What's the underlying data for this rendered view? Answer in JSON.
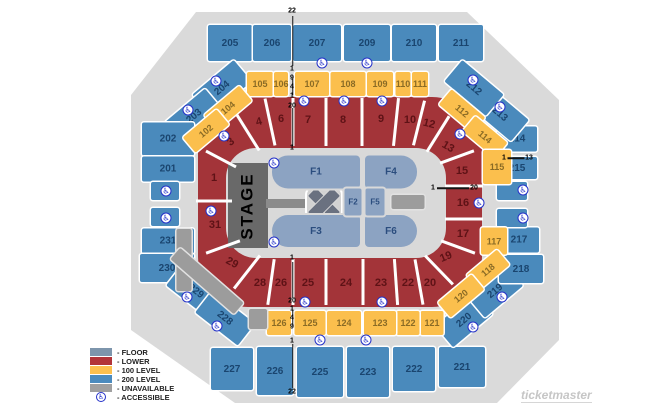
{
  "brand": "ticketmaster",
  "colors": {
    "floor": "#8CA3C2",
    "lower": "#A33439",
    "level100": "#FBBF4D",
    "level200": "#4A8ABC",
    "unavailable": "#9C9C9C",
    "stage": "#696969",
    "accessible": "#2431C9"
  },
  "legend": {
    "items": [
      {
        "label": "- FLOOR",
        "swatch": "#7D95AC"
      },
      {
        "label": "- LOWER",
        "swatch": "#B23439"
      },
      {
        "label": "- 100 LEVEL",
        "swatch": "#FCC04F"
      },
      {
        "label": "- 200 LEVEL",
        "swatch": "#4B8BBE"
      },
      {
        "label": "- UNAVAILABLE",
        "swatch": "#A0A0A0"
      },
      {
        "label": "- ACCESSIBLE",
        "swatch": "icon"
      }
    ]
  },
  "map": {
    "stage_label": "STAGE",
    "sections": [
      {
        "label": "205",
        "lv": "200",
        "cx": 230,
        "cy": 43,
        "w": 44,
        "h": 36
      },
      {
        "label": "206",
        "lv": "200",
        "cx": 272,
        "cy": 43,
        "w": 38,
        "h": 36
      },
      {
        "label": "207",
        "lv": "200",
        "cx": 317,
        "cy": 43,
        "w": 48,
        "h": 36
      },
      {
        "label": "209",
        "lv": "200",
        "cx": 367,
        "cy": 43,
        "w": 46,
        "h": 36
      },
      {
        "label": "210",
        "lv": "200",
        "cx": 414,
        "cy": 43,
        "w": 44,
        "h": 36
      },
      {
        "label": "211",
        "lv": "200",
        "cx": 461,
        "cy": 43,
        "w": 44,
        "h": 36
      },
      {
        "label": "204",
        "lv": "200",
        "cx": 222,
        "cy": 88,
        "w": 54,
        "h": 28,
        "r": -40
      },
      {
        "label": "203",
        "lv": "200",
        "cx": 194,
        "cy": 116,
        "w": 52,
        "h": 28,
        "r": -40
      },
      {
        "label": "202",
        "lv": "200",
        "cx": 168,
        "cy": 139,
        "w": 52,
        "h": 33
      },
      {
        "label": "201",
        "lv": "200",
        "cx": 168,
        "cy": 169,
        "w": 52,
        "h": 25
      },
      {
        "label": "",
        "lv": "200",
        "cx": 165,
        "cy": 191,
        "w": 28,
        "h": 18
      },
      {
        "label": "",
        "lv": "200",
        "cx": 165,
        "cy": 217,
        "w": 28,
        "h": 18
      },
      {
        "label": "231",
        "lv": "200",
        "cx": 168,
        "cy": 241,
        "w": 52,
        "h": 25
      },
      {
        "label": "230",
        "lv": "200",
        "cx": 167,
        "cy": 268,
        "w": 54,
        "h": 28
      },
      {
        "label": "229",
        "lv": "200",
        "cx": 196,
        "cy": 291,
        "w": 54,
        "h": 28,
        "r": 38
      },
      {
        "label": "228",
        "lv": "200",
        "cx": 225,
        "cy": 318,
        "w": 54,
        "h": 28,
        "r": 38
      },
      {
        "label": "227",
        "lv": "200",
        "cx": 232,
        "cy": 369,
        "w": 42,
        "h": 42
      },
      {
        "label": "226",
        "lv": "200",
        "cx": 275,
        "cy": 371,
        "w": 36,
        "h": 48
      },
      {
        "label": "225",
        "lv": "200",
        "cx": 320,
        "cy": 372,
        "w": 46,
        "h": 50
      },
      {
        "label": "223",
        "lv": "200",
        "cx": 368,
        "cy": 372,
        "w": 42,
        "h": 50
      },
      {
        "label": "222",
        "lv": "200",
        "cx": 414,
        "cy": 369,
        "w": 42,
        "h": 44
      },
      {
        "label": "221",
        "lv": "200",
        "cx": 462,
        "cy": 367,
        "w": 46,
        "h": 40
      },
      {
        "label": "220",
        "lv": "200",
        "cx": 464,
        "cy": 320,
        "w": 52,
        "h": 28,
        "r": -40
      },
      {
        "label": "219",
        "lv": "200",
        "cx": 495,
        "cy": 291,
        "w": 50,
        "h": 28,
        "r": -40
      },
      {
        "label": "218",
        "lv": "200",
        "cx": 521,
        "cy": 269,
        "w": 44,
        "h": 28
      },
      {
        "label": "217",
        "lv": "200",
        "cx": 519,
        "cy": 240,
        "w": 40,
        "h": 25
      },
      {
        "label": "",
        "lv": "200",
        "cx": 512,
        "cy": 218,
        "w": 30,
        "h": 18
      },
      {
        "label": "",
        "lv": "200",
        "cx": 512,
        "cy": 191,
        "w": 30,
        "h": 18
      },
      {
        "label": "215",
        "lv": "200",
        "cx": 517,
        "cy": 168,
        "w": 40,
        "h": 22
      },
      {
        "label": "214",
        "lv": "200",
        "cx": 517,
        "cy": 139,
        "w": 40,
        "h": 25
      },
      {
        "label": "213",
        "lv": "200",
        "cx": 500,
        "cy": 114,
        "w": 52,
        "h": 28,
        "r": 40
      },
      {
        "label": "212",
        "lv": "200",
        "cx": 474,
        "cy": 88,
        "w": 54,
        "h": 28,
        "r": 40
      },
      {
        "label": "105",
        "lv": "100",
        "cx": 260,
        "cy": 84,
        "w": 26,
        "h": 24
      },
      {
        "label": "106",
        "lv": "100",
        "cx": 281,
        "cy": 84,
        "w": 14,
        "h": 24
      },
      {
        "label": "107",
        "lv": "100",
        "cx": 312,
        "cy": 84,
        "w": 34,
        "h": 24
      },
      {
        "label": "108",
        "lv": "100",
        "cx": 348,
        "cy": 84,
        "w": 35,
        "h": 24
      },
      {
        "label": "109",
        "lv": "100",
        "cx": 380,
        "cy": 84,
        "w": 26,
        "h": 24
      },
      {
        "label": "110",
        "lv": "100",
        "cx": 403,
        "cy": 84,
        "w": 15,
        "h": 24
      },
      {
        "label": "111",
        "lv": "100",
        "cx": 420,
        "cy": 84,
        "w": 16,
        "h": 24
      },
      {
        "label": "112",
        "lv": "100",
        "cx": 462,
        "cy": 111,
        "w": 44,
        "h": 20,
        "r": 40
      },
      {
        "label": "114",
        "lv": "100",
        "cx": 485,
        "cy": 137,
        "w": 42,
        "h": 20,
        "r": 40
      },
      {
        "label": "115",
        "lv": "100",
        "cx": 497,
        "cy": 167,
        "w": 28,
        "h": 34
      },
      {
        "label": "117",
        "lv": "100",
        "cx": 494,
        "cy": 241,
        "w": 26,
        "h": 27
      },
      {
        "label": "118",
        "lv": "100",
        "cx": 488,
        "cy": 270,
        "w": 40,
        "h": 20,
        "r": -40
      },
      {
        "label": "120",
        "lv": "100",
        "cx": 461,
        "cy": 296,
        "w": 44,
        "h": 20,
        "r": -40
      },
      {
        "label": "121",
        "lv": "100",
        "cx": 432,
        "cy": 323,
        "w": 23,
        "h": 24
      },
      {
        "label": "122",
        "lv": "100",
        "cx": 408,
        "cy": 323,
        "w": 23,
        "h": 24
      },
      {
        "label": "123",
        "lv": "100",
        "cx": 380,
        "cy": 323,
        "w": 32,
        "h": 24
      },
      {
        "label": "124",
        "lv": "100",
        "cx": 344,
        "cy": 323,
        "w": 34,
        "h": 24
      },
      {
        "label": "125",
        "lv": "100",
        "cx": 310,
        "cy": 323,
        "w": 31,
        "h": 24
      },
      {
        "label": "126",
        "lv": "100",
        "cx": 279,
        "cy": 323,
        "w": 24,
        "h": 24
      },
      {
        "label": "104",
        "lv": "100",
        "cx": 228,
        "cy": 108,
        "w": 46,
        "h": 20,
        "r": -40
      },
      {
        "label": "102",
        "lv": "100",
        "cx": 206,
        "cy": 131,
        "w": 44,
        "h": 20,
        "r": -40
      },
      {
        "label": "F1",
        "lv": "floor",
        "cx": 316,
        "cy": 172,
        "w": 88,
        "h": 33,
        "br": "16px 4px 4px 16px"
      },
      {
        "label": "F4",
        "lv": "floor",
        "cx": 391,
        "cy": 172,
        "w": 52,
        "h": 33,
        "br": "4px 16px 16px 4px"
      },
      {
        "label": "F3",
        "lv": "floor",
        "cx": 316,
        "cy": 231,
        "w": 88,
        "h": 32,
        "br": "16px 4px 4px 16px"
      },
      {
        "label": "F6",
        "lv": "floor",
        "cx": 391,
        "cy": 231,
        "w": 52,
        "h": 32,
        "br": "4px 16px 16px 4px"
      },
      {
        "label": "F2",
        "lv": "floor",
        "cx": 353,
        "cy": 202,
        "w": 17,
        "h": 27,
        "fs": 8
      },
      {
        "label": "F5",
        "lv": "floor",
        "cx": 375,
        "cy": 202,
        "w": 19,
        "h": 27,
        "fs": 8
      },
      {
        "label": "",
        "lv": "unavail",
        "cx": 184,
        "cy": 260,
        "w": 15,
        "h": 62
      },
      {
        "label": "",
        "lv": "unavail",
        "cx": 207,
        "cy": 281,
        "w": 84,
        "h": 15,
        "r": 41
      },
      {
        "label": "",
        "lv": "unavail",
        "cx": 258,
        "cy": 319,
        "w": 18,
        "h": 20
      },
      {
        "label": "",
        "lv": "unavail",
        "cx": 408,
        "cy": 202,
        "w": 33,
        "h": 14
      },
      {
        "label": "1",
        "lv": "lower",
        "cx": 214,
        "cy": 178,
        "w": 20,
        "h": 14
      },
      {
        "label": "3",
        "lv": "lower",
        "cx": 231,
        "cy": 142,
        "w": 20,
        "h": 14,
        "r": -38
      },
      {
        "label": "4",
        "lv": "lower",
        "cx": 259,
        "cy": 122,
        "w": 20,
        "h": 14,
        "r": -14
      },
      {
        "label": "6",
        "lv": "lower",
        "cx": 281,
        "cy": 119,
        "w": 20,
        "h": 14
      },
      {
        "label": "7",
        "lv": "lower",
        "cx": 308,
        "cy": 120,
        "w": 20,
        "h": 14
      },
      {
        "label": "8",
        "lv": "lower",
        "cx": 343,
        "cy": 120,
        "w": 20,
        "h": 14
      },
      {
        "label": "9",
        "lv": "lower",
        "cx": 381,
        "cy": 119,
        "w": 20,
        "h": 14
      },
      {
        "label": "10",
        "lv": "lower",
        "cx": 410,
        "cy": 120,
        "w": 20,
        "h": 14
      },
      {
        "label": "12",
        "lv": "lower",
        "cx": 429,
        "cy": 124,
        "w": 20,
        "h": 14,
        "r": 14
      },
      {
        "label": "13",
        "lv": "lower",
        "cx": 448,
        "cy": 147,
        "w": 20,
        "h": 14,
        "r": 30
      },
      {
        "label": "15",
        "lv": "lower",
        "cx": 462,
        "cy": 171,
        "w": 20,
        "h": 14
      },
      {
        "label": "16",
        "lv": "lower",
        "cx": 463,
        "cy": 203,
        "w": 20,
        "h": 14
      },
      {
        "label": "17",
        "lv": "lower",
        "cx": 463,
        "cy": 234,
        "w": 20,
        "h": 14
      },
      {
        "label": "19",
        "lv": "lower",
        "cx": 446,
        "cy": 257,
        "w": 20,
        "h": 14,
        "r": -22
      },
      {
        "label": "20",
        "lv": "lower",
        "cx": 430,
        "cy": 283,
        "w": 20,
        "h": 14
      },
      {
        "label": "22",
        "lv": "lower",
        "cx": 408,
        "cy": 283,
        "w": 20,
        "h": 14
      },
      {
        "label": "23",
        "lv": "lower",
        "cx": 381,
        "cy": 283,
        "w": 20,
        "h": 14
      },
      {
        "label": "24",
        "lv": "lower",
        "cx": 346,
        "cy": 283,
        "w": 20,
        "h": 14
      },
      {
        "label": "25",
        "lv": "lower",
        "cx": 308,
        "cy": 283,
        "w": 20,
        "h": 14
      },
      {
        "label": "26",
        "lv": "lower",
        "cx": 281,
        "cy": 283,
        "w": 20,
        "h": 14
      },
      {
        "label": "28",
        "lv": "lower",
        "cx": 260,
        "cy": 283,
        "w": 20,
        "h": 14
      },
      {
        "label": "29",
        "lv": "lower",
        "cx": 232,
        "cy": 263,
        "w": 20,
        "h": 14,
        "r": 28
      },
      {
        "label": "31",
        "lv": "lower",
        "cx": 215,
        "cy": 225,
        "w": 20,
        "h": 14
      }
    ],
    "aisles": [
      {
        "x": 247,
        "y": 131,
        "l": 46,
        "r": -32
      },
      {
        "x": 270,
        "y": 122,
        "l": 48,
        "r": -12
      },
      {
        "x": 293,
        "y": 122,
        "l": 48,
        "r": 0
      },
      {
        "x": 326,
        "y": 122,
        "l": 48,
        "r": 0
      },
      {
        "x": 362,
        "y": 122,
        "l": 48,
        "r": 0
      },
      {
        "x": 396,
        "y": 122,
        "l": 48,
        "r": 6
      },
      {
        "x": 419,
        "y": 123,
        "l": 46,
        "r": 14
      },
      {
        "x": 438,
        "y": 134,
        "l": 42,
        "r": 32
      },
      {
        "x": 457,
        "y": 157,
        "l": 36,
        "r": 70
      },
      {
        "x": 464,
        "y": 186,
        "l": 38,
        "r": 90
      },
      {
        "x": 464,
        "y": 219,
        "l": 38,
        "r": 90
      },
      {
        "x": 458,
        "y": 247,
        "l": 36,
        "r": -70
      },
      {
        "x": 439,
        "y": 270,
        "l": 40,
        "r": -44
      },
      {
        "x": 419,
        "y": 282,
        "l": 46,
        "r": -10
      },
      {
        "x": 396,
        "y": 282,
        "l": 46,
        "r": -4
      },
      {
        "x": 363,
        "y": 282,
        "l": 46,
        "r": 0
      },
      {
        "x": 326,
        "y": 282,
        "l": 46,
        "r": 0
      },
      {
        "x": 293,
        "y": 282,
        "l": 46,
        "r": 0
      },
      {
        "x": 271,
        "y": 282,
        "l": 46,
        "r": 8
      },
      {
        "x": 247,
        "y": 272,
        "l": 42,
        "r": 38
      },
      {
        "x": 223,
        "y": 247,
        "l": 36,
        "r": 70
      },
      {
        "x": 214,
        "y": 201,
        "l": 36,
        "r": 90
      },
      {
        "x": 221,
        "y": 159,
        "l": 34,
        "r": -62
      }
    ],
    "markers": [
      {
        "line": {
          "x": 292.5,
          "y": 41,
          "l": 50,
          "dir": "v"
        },
        "labels": [
          {
            "t": "22",
            "x": 292,
            "y": 11
          },
          {
            "t": "1",
            "x": 292,
            "y": 69
          }
        ]
      },
      {
        "line": {
          "x": 292.5,
          "y": 87,
          "l": 16,
          "dir": "v"
        },
        "labels": [
          {
            "t": "9",
            "x": 292,
            "y": 78
          },
          {
            "t": "4",
            "x": 292,
            "y": 87
          },
          {
            "t": "1",
            "x": 292,
            "y": 96
          }
        ]
      },
      {
        "line": {
          "x": 292.5,
          "y": 127,
          "l": 38,
          "dir": "v"
        },
        "labels": [
          {
            "t": "20",
            "x": 292,
            "y": 106
          },
          {
            "t": "1",
            "x": 292,
            "y": 148
          }
        ]
      },
      {
        "line": {
          "x": 292.5,
          "y": 280,
          "l": 36,
          "dir": "v"
        },
        "labels": [
          {
            "t": "1",
            "x": 292,
            "y": 258
          },
          {
            "t": "20",
            "x": 292,
            "y": 301
          }
        ]
      },
      {
        "line": {
          "x": 292.5,
          "y": 318,
          "l": 16,
          "dir": "v"
        },
        "labels": [
          {
            "t": "1",
            "x": 292,
            "y": 309
          },
          {
            "t": "4",
            "x": 292,
            "y": 318
          },
          {
            "t": "9",
            "x": 292,
            "y": 327
          }
        ]
      },
      {
        "line": {
          "x": 292.5,
          "y": 366,
          "l": 44,
          "dir": "v"
        },
        "labels": [
          {
            "t": "1",
            "x": 292,
            "y": 341
          },
          {
            "t": "22",
            "x": 292,
            "y": 392
          }
        ]
      },
      {
        "line": {
          "x": 516,
          "y": 158,
          "l": 17,
          "dir": "h"
        },
        "labels": [
          {
            "t": "1",
            "x": 504,
            "y": 158
          },
          {
            "t": "13",
            "x": 529,
            "y": 158
          }
        ]
      },
      {
        "line": {
          "x": 453,
          "y": 188,
          "l": 32,
          "dir": "h"
        },
        "labels": [
          {
            "t": "1",
            "x": 433,
            "y": 188
          },
          {
            "t": "20",
            "x": 474,
            "y": 188
          }
        ]
      }
    ],
    "icons": [
      {
        "x": 216,
        "y": 81
      },
      {
        "x": 322,
        "y": 63
      },
      {
        "x": 367,
        "y": 63
      },
      {
        "x": 473,
        "y": 80
      },
      {
        "x": 188,
        "y": 110
      },
      {
        "x": 224,
        "y": 136
      },
      {
        "x": 304,
        "y": 101
      },
      {
        "x": 344,
        "y": 101
      },
      {
        "x": 382,
        "y": 101
      },
      {
        "x": 460,
        "y": 134
      },
      {
        "x": 500,
        "y": 107
      },
      {
        "x": 274,
        "y": 163
      },
      {
        "x": 274,
        "y": 242
      },
      {
        "x": 479,
        "y": 203
      },
      {
        "x": 211,
        "y": 211
      },
      {
        "x": 166,
        "y": 191
      },
      {
        "x": 166,
        "y": 218
      },
      {
        "x": 523,
        "y": 190
      },
      {
        "x": 523,
        "y": 218
      },
      {
        "x": 187,
        "y": 297
      },
      {
        "x": 217,
        "y": 326
      },
      {
        "x": 305,
        "y": 302
      },
      {
        "x": 382,
        "y": 302
      },
      {
        "x": 320,
        "y": 340
      },
      {
        "x": 366,
        "y": 340
      },
      {
        "x": 502,
        "y": 297
      },
      {
        "x": 473,
        "y": 327
      }
    ]
  }
}
